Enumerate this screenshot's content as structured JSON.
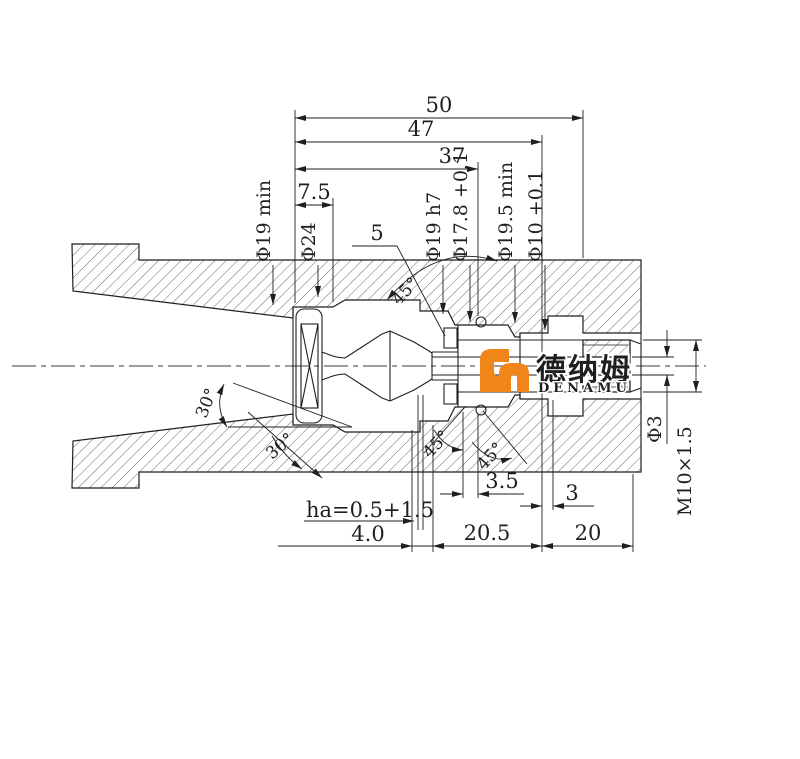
{
  "drawing": {
    "description": "cross-section drawing of collet nozzle assembly",
    "top_dims": {
      "d50": "50",
      "d47": "47",
      "d37": "37",
      "d7_5": "7.5"
    },
    "dia_labels": {
      "phi19min": "Φ19 min",
      "phi24": "Φ24",
      "n5": "5",
      "phi19h7": "Φ19 h7",
      "phi17_8": "Φ17.8 +0.1",
      "phi19_5min": "Φ19.5 min",
      "phi10": "Φ10 +0.1"
    },
    "angle_labels": {
      "a45_top": "45°",
      "a30_upper": "30°",
      "a30_lower": "30°",
      "a45_b1": "45°",
      "a45_b2": "45°"
    },
    "bottom_dims": {
      "ha": "ha=0.5+1.5",
      "d4": "4.0",
      "d20_5": "20.5",
      "d20": "20",
      "d3_5": "3.5",
      "d3": "3"
    },
    "right_dims": {
      "phi3": "Φ3",
      "m10": "M10×1.5"
    }
  },
  "logo": {
    "cn": "德纳姆",
    "en": "DENAMU",
    "colors": {
      "orange": "#F08519",
      "green": "#8CC427"
    }
  }
}
